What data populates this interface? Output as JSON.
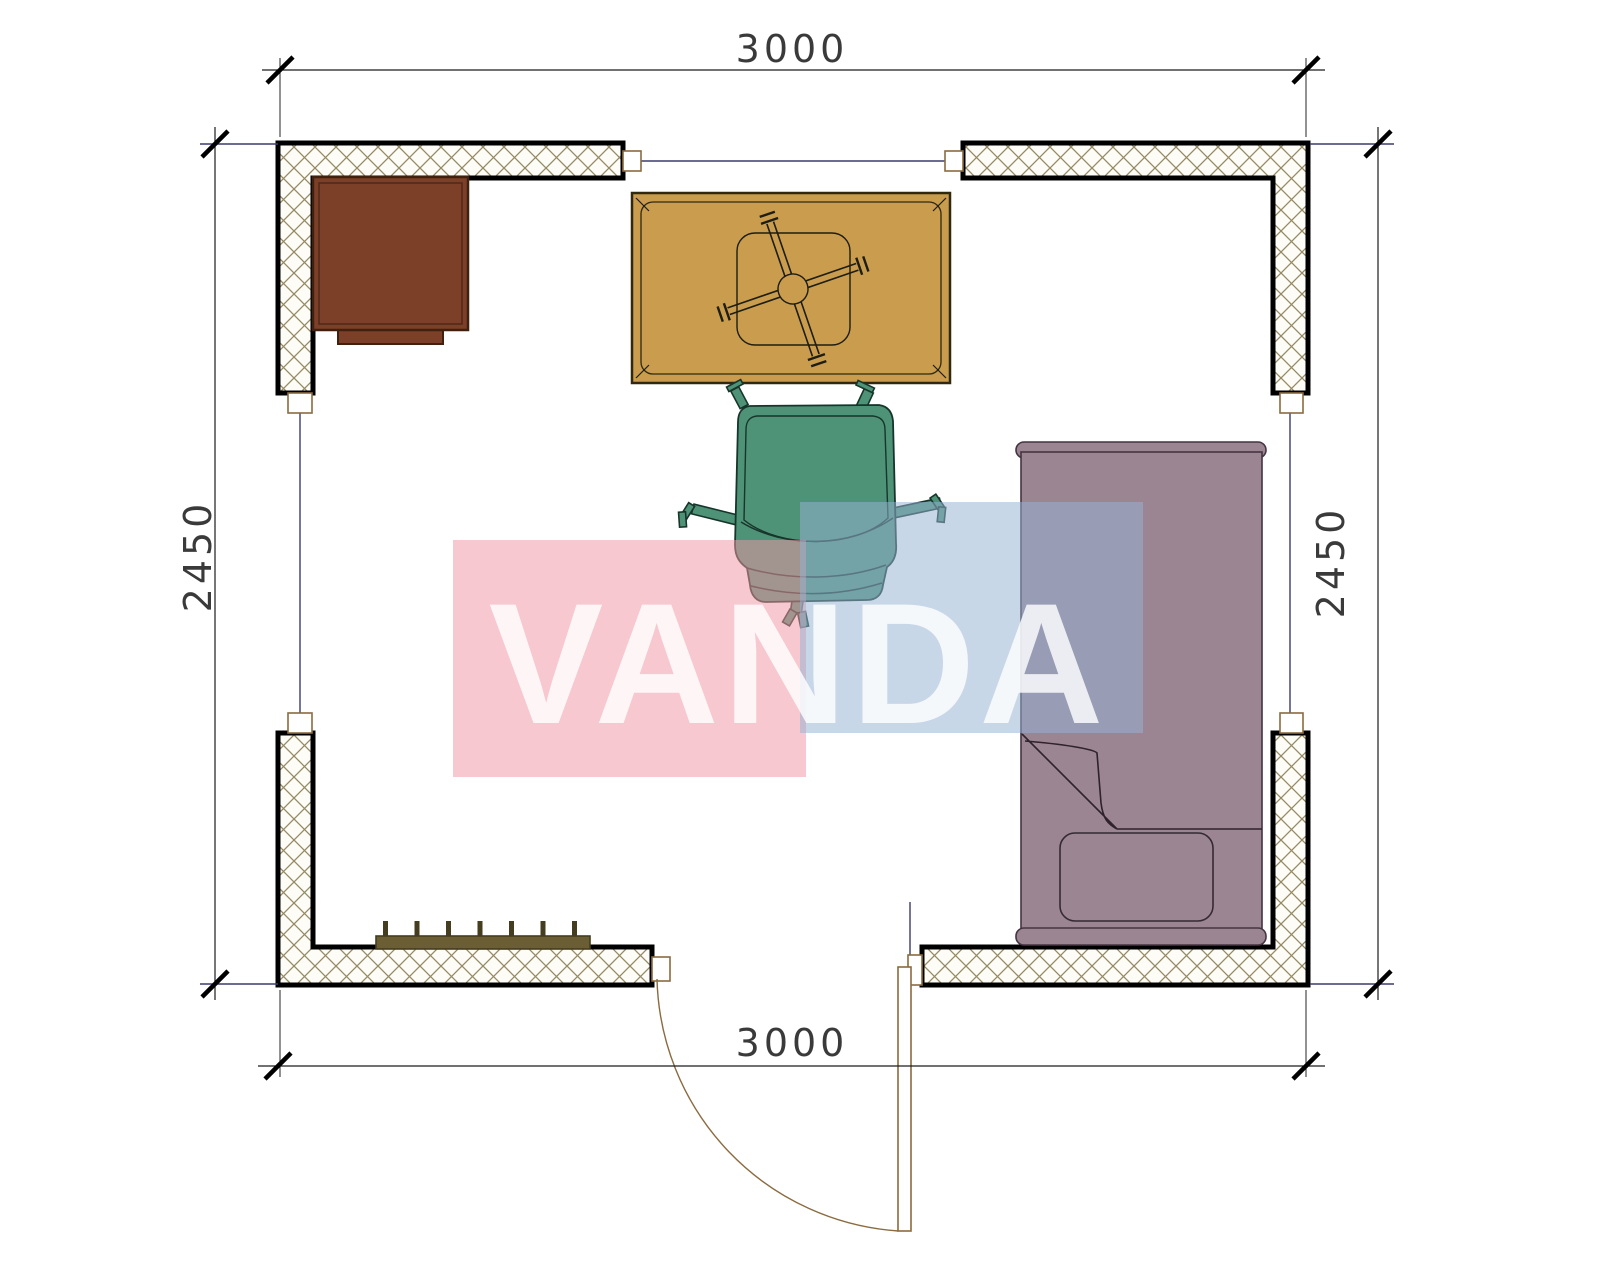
{
  "plan": {
    "dimensions": {
      "top": "3000",
      "bottom": "3000",
      "left": "2450",
      "right": "2450"
    },
    "watermark": {
      "text": "VANDA"
    },
    "furniture": [
      {
        "name": "cabinet-desk",
        "color": "#7c3f27"
      },
      {
        "name": "table-with-fan-symbol",
        "color": "#c99c4e"
      },
      {
        "name": "armchair",
        "color": "#4e9378"
      },
      {
        "name": "bed",
        "color": "#9b8593"
      },
      {
        "name": "radiator",
        "color": "#6b5e35"
      }
    ],
    "colors": {
      "desk": "#7c3f27",
      "desk_border": "#40200f",
      "table": "#c99c4e",
      "table_border": "#30290f",
      "chair": "#4e9378",
      "chair_border": "#17352a",
      "bed": "#9b8593",
      "bed_border": "#453441",
      "radiator": "#6b5e35",
      "radiator_dark": "#453d1f",
      "wall_border": "#000000",
      "hatch_line": "#958a64",
      "hatch_bg": "#fdfcf7",
      "line_navy": "#3b3b6e",
      "dim_line": "#1c1c1c",
      "ext_line": "#3a3a3a",
      "dim_text": "#1f1f1f",
      "frame_tan": "#8a6b3f",
      "door_arc": "#8a6b3f",
      "ink": "#1d1d12",
      "watermark_pink": "rgba(240,150,163,0.52)",
      "watermark_blue": "rgba(150,178,210,0.52)",
      "watermark_text": "rgba(255,255,255,0.82)"
    }
  }
}
